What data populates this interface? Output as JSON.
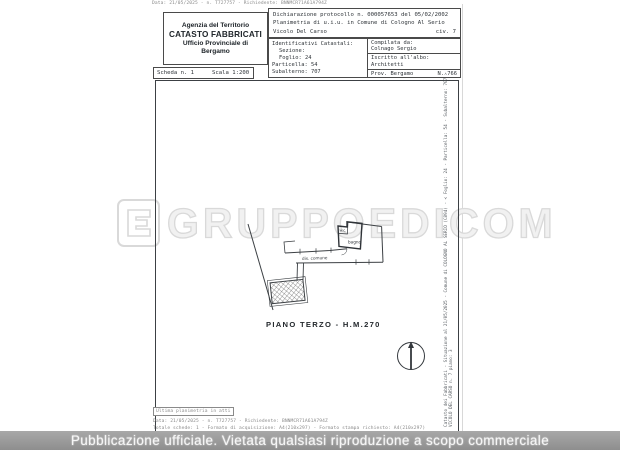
{
  "page": {
    "top_meta": "Data: 21/05/2025 - n. T727757 - Richiedente: BNNMCR71A61A794Z",
    "agency_box": {
      "line1": "Agenzia del Territorio",
      "line2": "CATASTO FABBRICATI",
      "line3": "Ufficio Provinciale di",
      "line4": "Bergamo"
    },
    "declaration_box": {
      "protocol": "Dichiarazione protocollo n. 000057653 del 05/02/2002",
      "planimetria": "Planimetria di u.i.u. in Comune di Cologno Al Serio",
      "street": "Vicolo Del Carso",
      "civic": "civ. 7"
    },
    "catastali_box": {
      "title": "Identificativi Catastali:",
      "sezione": "Sezione:",
      "foglio": "Foglio: 24",
      "particella": "Particella: 54",
      "subalterno": "Subalterno: 707"
    },
    "compiler_box": {
      "compilata_label": "Compilata da:",
      "compilata_value": "Colnago Sergio",
      "albo_label": "Iscritto all'albo:",
      "albo_value": "Architetti",
      "prov": "Prov. Bergamo",
      "num": "N.  766"
    },
    "scheda_box": {
      "scheda": "Scheda n. 1",
      "scala": "Scala 1:200"
    },
    "plan": {
      "caption": "PIANO TERZO - H.M.270",
      "label_bagno": "bagno",
      "label_wc": "w.c.",
      "label_corridor": "dis. comune",
      "side_text_line1": "Catasto dei Fabbricati - Situazione al 21/05/2025 - Comune di COLOGNO AL SERIO (C894) - < Foglio: 24 - Particella: 54 - Subalterno: 707 >",
      "side_text_line2": "VICOLO DEL CARSO n. 7 piano: 3"
    },
    "footer": {
      "ultima": "Ultima planimetria in atti",
      "line1": "Data: 21/05/2025 - n. T727757 - Richiedente: BNNMCR71A61A794Z",
      "line2": "Totale schede: 1 - Formato di acquisizione: A4(210x297) - Formato stampa richiesto: A4(210x297)"
    }
  },
  "watermark": {
    "text": "GRUPPOEDICOM"
  },
  "banner": {
    "text": "Pubblicazione ufficiale. Vietata qualsiasi riproduzione a scopo commerciale"
  },
  "colors": {
    "banner_bg": "#9b9b9b",
    "watermark": "#d9d9d9",
    "line": "#3c4044"
  }
}
